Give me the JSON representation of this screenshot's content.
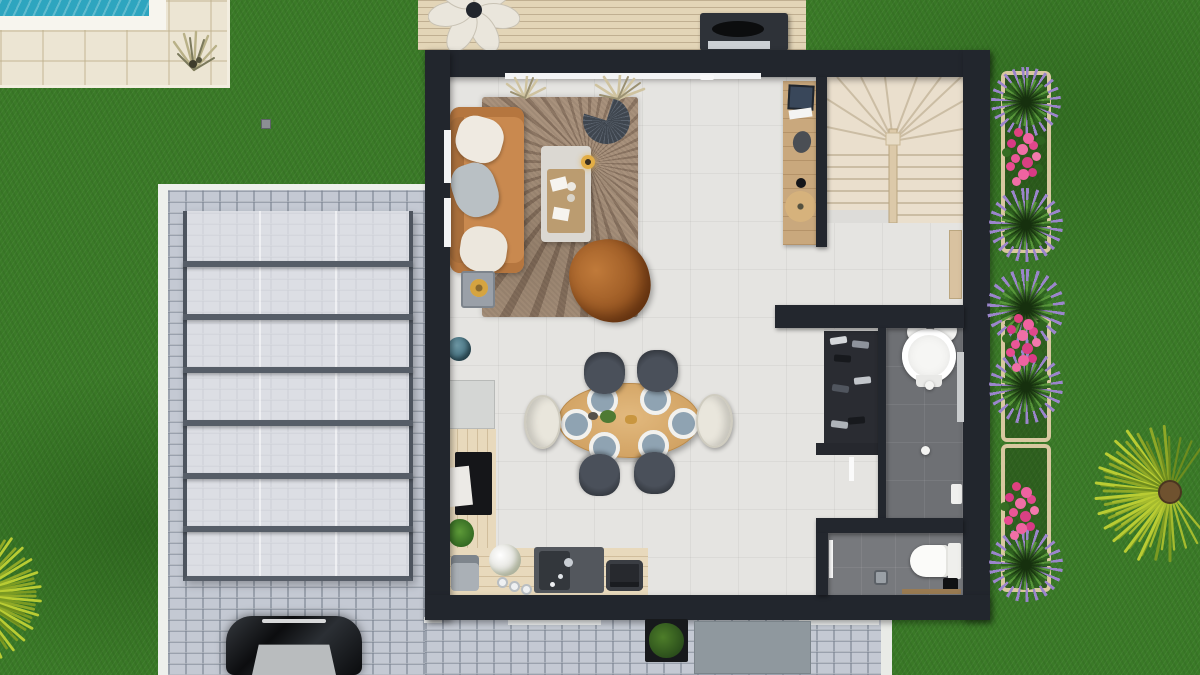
{
  "meta": {
    "view": "top-down-3d-floor-plan-render",
    "width_px": 1200,
    "height_px": 675,
    "visible_text": "none"
  },
  "palette": {
    "lawn_green": "#3a7a27",
    "pool_water": "#2ea5bf",
    "pool_deck_stone": "#ece5d3",
    "cobblestone": "#c4c9d3",
    "canopy_glass": "#e2e4e8",
    "canopy_frame": "#565d67",
    "house_wall": "#22262d",
    "interior_floor": "#e5e4e1",
    "wet_room_floor": "#6e7074",
    "deck_wood": "#e3d5b7",
    "stair_wood": "#eadfcd",
    "stair_line": "#cbbda4",
    "desk_wood": "#c9a87d",
    "counter_wood": "#e8d9bc",
    "dining_table_wood": "#d9ad70",
    "sofa_leather": "#c9894f",
    "rug_brown": "#a18a75",
    "butterfly_leather": "#a96327",
    "chair_dark": "#3d424a",
    "chair_cream": "#e9e6dc",
    "plate_blue": "#8fa3b2",
    "flower_pink": "#e84b90",
    "plant_purple": "#9b85cc",
    "plant_green": "#3f7d27",
    "palm_green": "#9fb42c",
    "palm_trunk": "#6f522f",
    "car_black": "#141619",
    "mat_gray": "#8f989e",
    "fixture_white": "#f4f4f2"
  },
  "exterior": {
    "items": [
      "swimming-pool-corner",
      "stone-pool-deck",
      "ornamental-grass-tuft",
      "lawn",
      "glass-canopy-carport",
      "cobblestone-driveway",
      "white-curb-edging",
      "parked-black-car",
      "wood-deck-terrace",
      "flower-shaped-lounge-chair",
      "barbecue-grill",
      "three-raised-flower-planters",
      "spiky-purple-green-plants",
      "pink-rose-clusters",
      "fan-palm-bottom-right",
      "fan-palm-bottom-left",
      "boxwood-shrub-planter",
      "gray-entry-mat"
    ]
  },
  "rooms": [
    {
      "name": "living-room",
      "items": [
        "tan-leather-sofa",
        "three-throw-pillows",
        "sunburst-rug",
        "coffee-table-with-tray",
        "gold-table-lamp",
        "dark-fan-wall-decor",
        "leather-butterfly-chair",
        "gray-side-table",
        "globe-decor"
      ]
    },
    {
      "name": "dining-area",
      "items": [
        "oval-wood-table",
        "six-place-settings-blue-plates",
        "four-dark-shell-chairs",
        "two-cream-end-chairs",
        "greenery-centerpiece"
      ]
    },
    {
      "name": "kitchen",
      "items": [
        "fridge",
        "l-shaped-wood-counter",
        "black-cooktop",
        "cutting-board",
        "herb-plant",
        "coffee-machine",
        "flower-vase",
        "three-canisters",
        "double-sink-with-faucet",
        "toaster"
      ]
    },
    {
      "name": "office-nook",
      "items": [
        "wood-desk",
        "monitor",
        "papers",
        "desk-pad",
        "round-rattan-stool"
      ]
    },
    {
      "name": "staircase",
      "items": [
        "winder-stairs-with-fan-treads",
        "center-newel",
        "stringer"
      ]
    },
    {
      "name": "closet",
      "items": [
        "open-wardrobe-with-clothes",
        "low-cabinet",
        "white-door"
      ]
    },
    {
      "name": "bathroom",
      "items": [
        "round-pedestal-basin",
        "two-faucet-columns",
        "ceiling-spots",
        "wall-shelf",
        "window-slit"
      ]
    },
    {
      "name": "wc",
      "items": [
        "toilet-with-tank",
        "waste-bin",
        "black-floor-item",
        "wood-sill",
        "white-door"
      ]
    }
  ]
}
